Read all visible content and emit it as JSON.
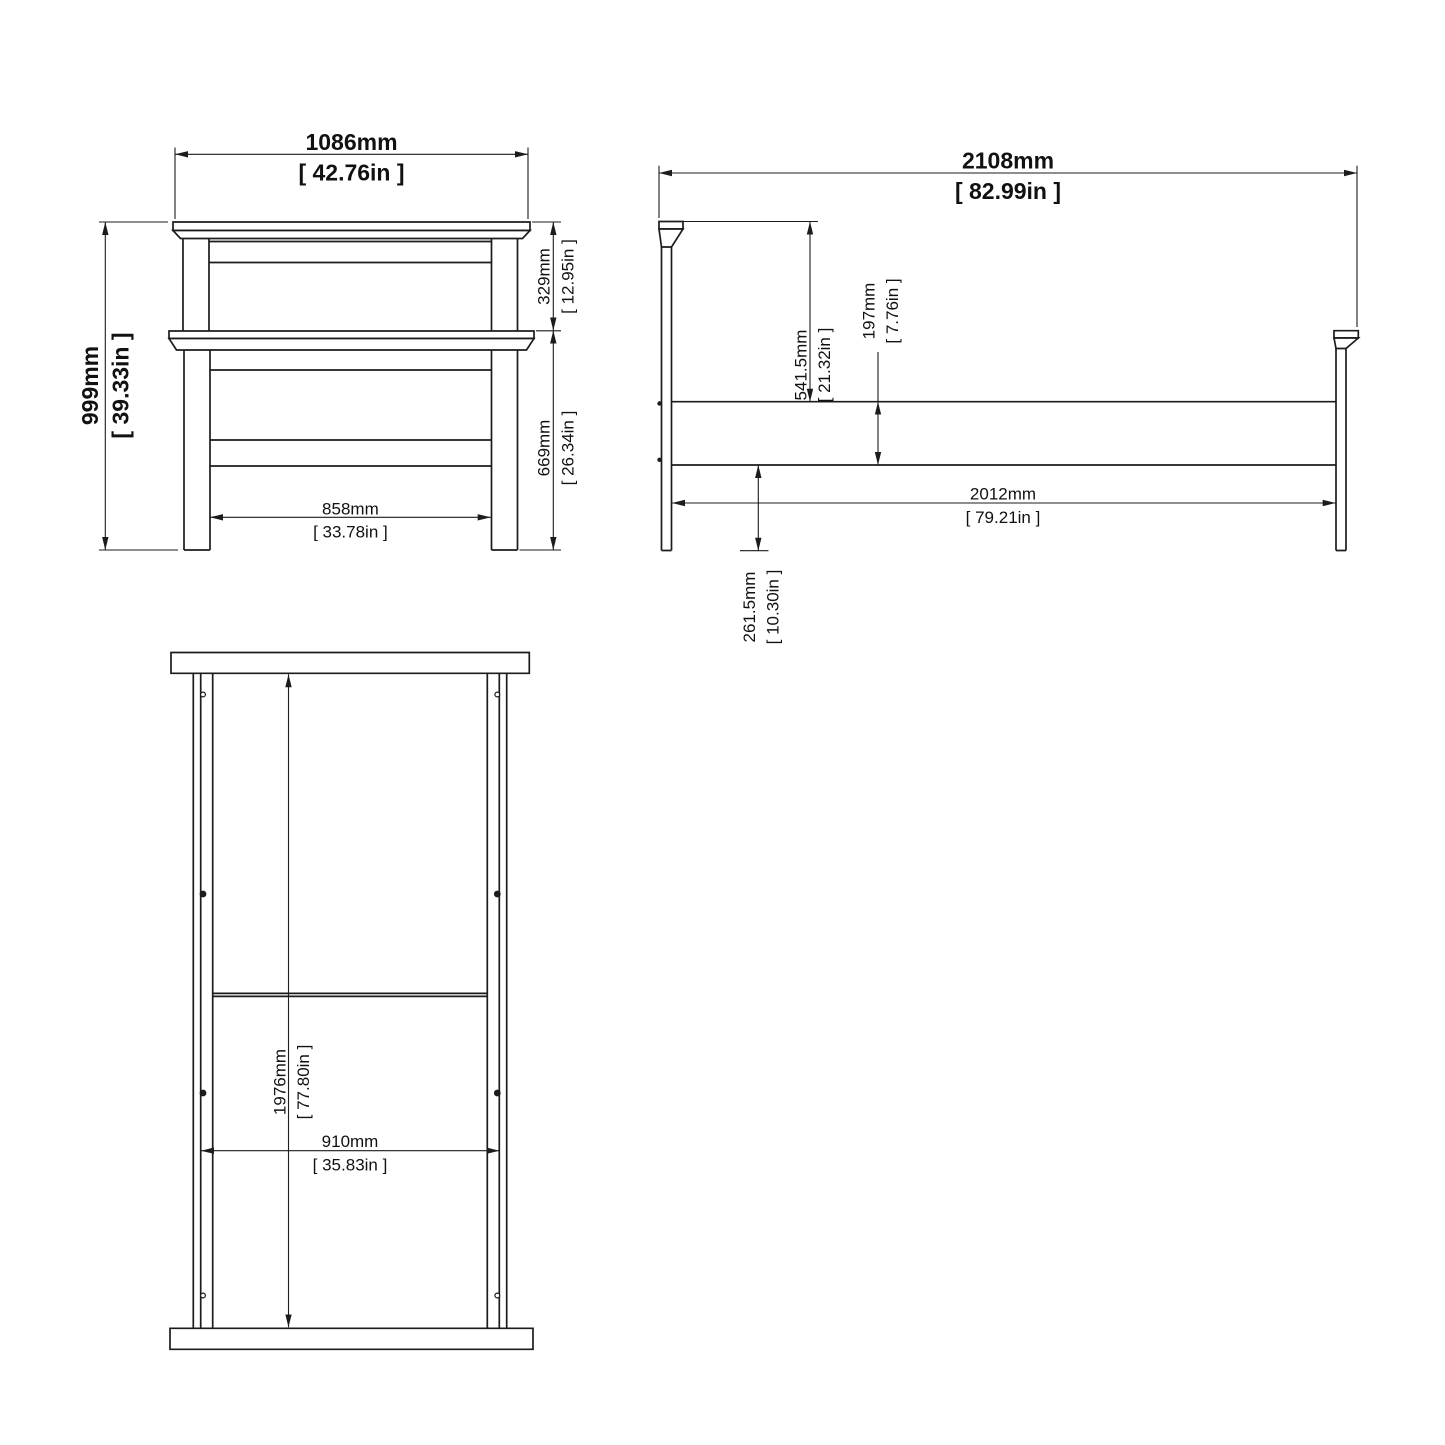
{
  "drawing": {
    "type": "furniture-technical-drawing",
    "background": "#ffffff",
    "line_color": "#1c1c1c",
    "views": {
      "front": {
        "overall_width": {
          "mm": "1086mm",
          "in": "[ 42.76in ]"
        },
        "overall_height": {
          "mm": "999mm",
          "in": "[ 39.33in ]"
        },
        "headboard_top_section": {
          "mm": "329mm",
          "in": "[ 12.95in ]"
        },
        "headboard_lower_section": {
          "mm": "669mm",
          "in": "[ 26.34in ]"
        },
        "inner_width": {
          "mm": "858mm",
          "in": "[ 33.78in ]"
        }
      },
      "side": {
        "overall_length": {
          "mm": "2108mm",
          "in": "[ 82.99in ]"
        },
        "headboard_to_rail": {
          "mm": "541.5mm",
          "in": "[ 21.32in ]"
        },
        "rail_height": {
          "mm": "197mm",
          "in": "[ 7.76in ]"
        },
        "inner_length": {
          "mm": "2012mm",
          "in": "[ 79.21in ]"
        },
        "floor_to_rail": {
          "mm": "261.5mm",
          "in": "[ 10.30in ]"
        }
      },
      "top": {
        "inner_length": {
          "mm": "1976mm",
          "in": "[ 77.80in ]"
        },
        "inner_width": {
          "mm": "910mm",
          "in": "[ 35.83in ]"
        }
      }
    }
  }
}
